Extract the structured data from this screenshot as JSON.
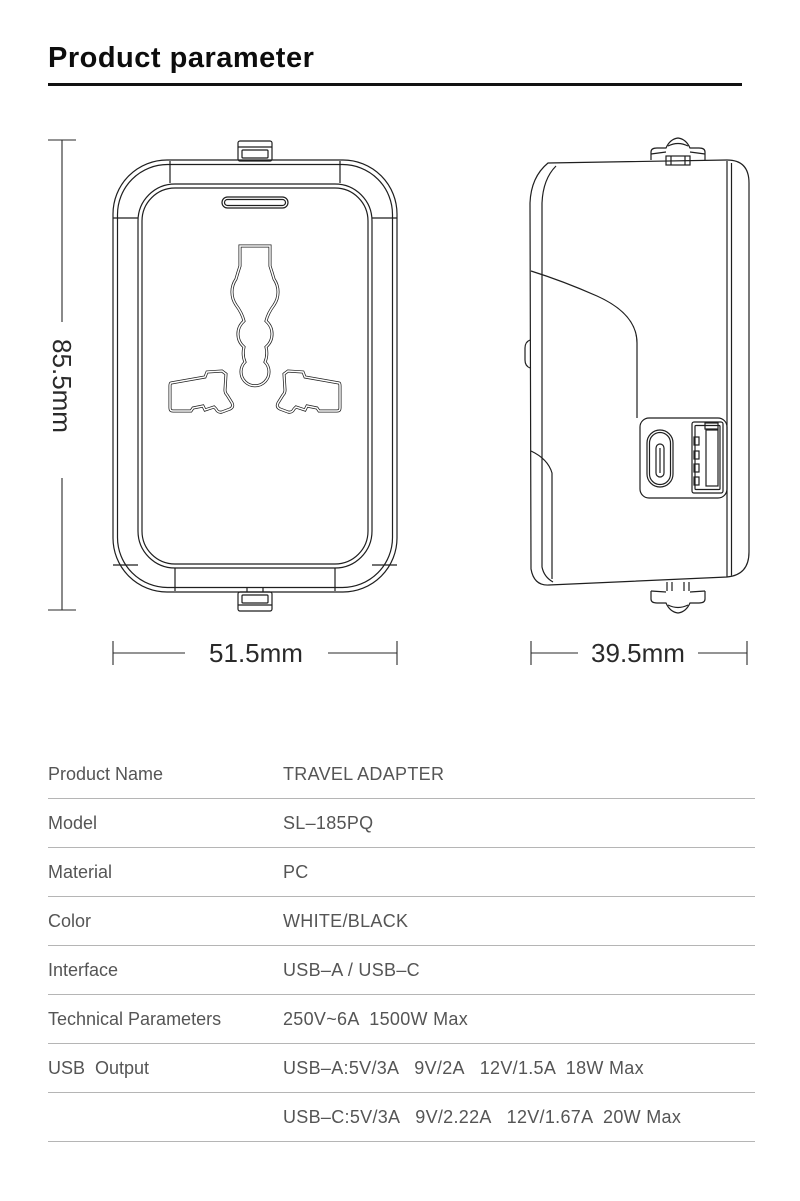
{
  "page": {
    "title": "Product parameter"
  },
  "diagram": {
    "height_dimension": "85.5mm",
    "front_width_dimension": "51.5mm",
    "side_width_dimension": "39.5mm"
  },
  "spec_table": {
    "rows": [
      {
        "label": "Product Name",
        "value": "TRAVEL ADAPTER"
      },
      {
        "label": "Model",
        "value": "SL–185PQ"
      },
      {
        "label": "Material",
        "value": "PC"
      },
      {
        "label": "Color",
        "value": "WHITE/BLACK"
      },
      {
        "label": "Interface",
        "value": "USB–A / USB–C"
      },
      {
        "label": "Technical Parameters",
        "value": "250V~6A  1500W Max"
      },
      {
        "label": "USB  Output",
        "value": "USB–A:5V/3A   9V/2A   12V/1.5A  18W Max"
      },
      {
        "label": "",
        "value": "USB–C:5V/3A   9V/2.22A   12V/1.67A  20W Max"
      }
    ]
  },
  "colors": {
    "line": "#1f1f1f",
    "table_text": "#555555",
    "divider": "#b5b5b5"
  }
}
